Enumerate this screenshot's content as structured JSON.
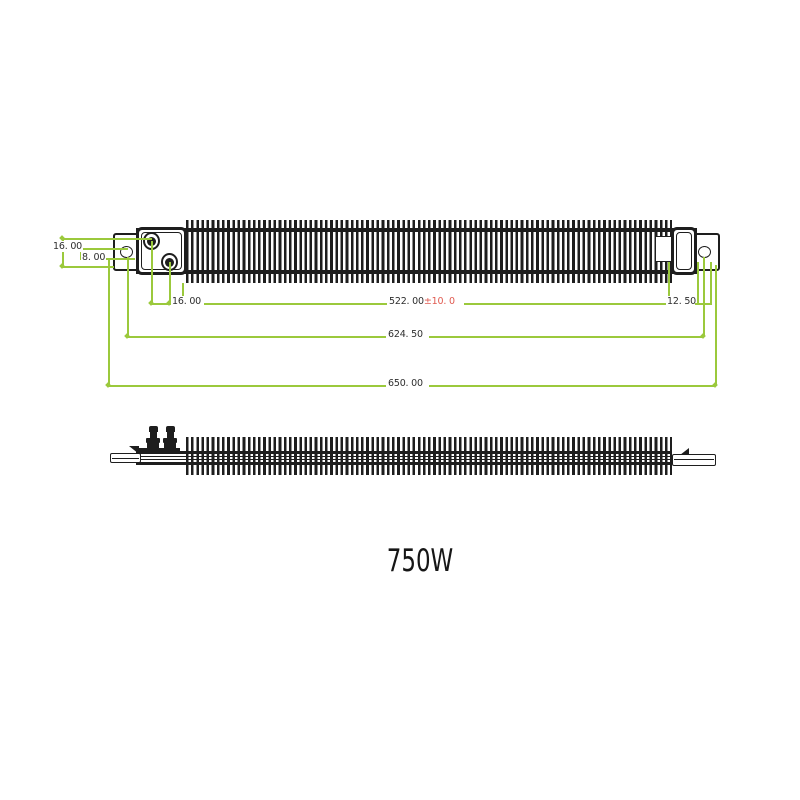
{
  "title": {
    "text": "750W"
  },
  "colors": {
    "dimension_line": "#9bc93c",
    "tolerance": "#e05a50",
    "ink": "#1e1e1e"
  },
  "dimensions": {
    "terminal_row_spacing": "16. 00",
    "hole_center_offset": "8. 00",
    "terminal_column_spacing": "16. 00",
    "finned_length": "522. 00",
    "finned_length_tolerance": "±10. 0",
    "end_hole_offset": "12. 50",
    "hole_to_hole_length": "624. 50",
    "overall_length": "650. 00"
  }
}
